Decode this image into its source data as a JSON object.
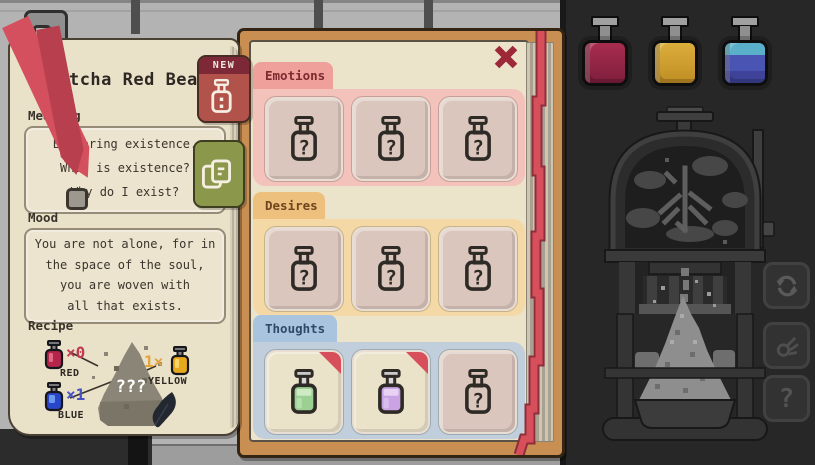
{
  "left_page": {
    "title": "Matcha Red Bean",
    "new_badge": "NEW",
    "meaning": {
      "label": "Meaning",
      "lines": [
        "Exploring existence.",
        "What is existence?",
        "Why do I exist?"
      ]
    },
    "mood": {
      "label": "Mood",
      "lines": [
        "You are not alone, for in",
        "the space of the soul,",
        "you are woven with",
        "all that exists."
      ]
    },
    "recipe": {
      "label": "Recipe",
      "unknown_text": "???",
      "ingredients": [
        {
          "name": "RED",
          "count": "×0",
          "color": "#c03a50"
        },
        {
          "name": "BLUE",
          "count": "×1",
          "color": "#4553c6"
        },
        {
          "name": "YELLOW",
          "count": "1×",
          "color": "#e2a43c"
        }
      ]
    }
  },
  "book": {
    "categories": [
      {
        "label": "Emotions",
        "tab_color": "#efa09a",
        "panel_color": "#f3c2ba",
        "slots": [
          {
            "state": "undiscovered"
          },
          {
            "state": "undiscovered"
          },
          {
            "state": "undiscovered"
          }
        ]
      },
      {
        "label": "Desires",
        "tab_color": "#eec07e",
        "panel_color": "#f4d9a6",
        "slots": [
          {
            "state": "undiscovered"
          },
          {
            "state": "undiscovered"
          },
          {
            "state": "undiscovered"
          }
        ]
      },
      {
        "label": "Thoughts",
        "tab_color": "#a9c4df",
        "panel_color": "#c0cfdb",
        "slots": [
          {
            "state": "discovered",
            "potion_color": "#9ccf92",
            "new": true
          },
          {
            "state": "discovered",
            "potion_color": "#c9a3e3",
            "new": true
          },
          {
            "state": "undiscovered"
          }
        ]
      }
    ]
  },
  "station": {
    "bottles": [
      {
        "name": "red-potion",
        "color": "#a82d4f"
      },
      {
        "name": "yellow-potion",
        "color": "#dcae3c"
      },
      {
        "name": "blue-potion",
        "color": "#4a54b2"
      }
    ],
    "machine_glyph": "氷"
  },
  "icons": {
    "unknown": "?",
    "close": "✕",
    "refresh": "↻",
    "help": "?"
  },
  "colors": {
    "ribbon_red": "#d84f5c",
    "book_cover": "#c98e52",
    "page_cream": "#ece3cb",
    "note_cream": "#eae1c9",
    "station_bg": "#272727"
  }
}
